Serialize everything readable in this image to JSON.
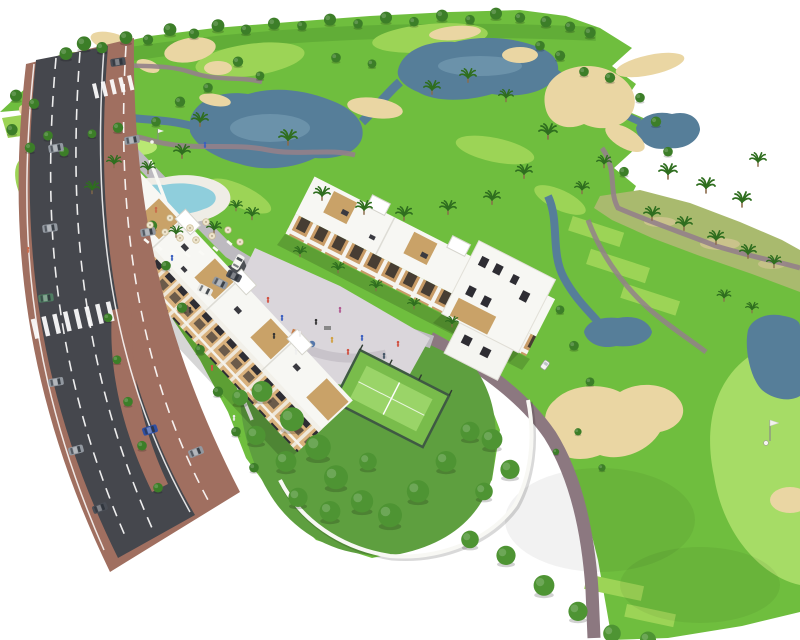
{
  "scene": {
    "alt_text": "Aerial 3D architectural render of a white apartment resort complex beside a golf course, with lakes, sand bunkers, palm trees, a lagoon swimming pool, a padel court, a central plaza and a diagonal boulevard with cars",
    "features": [
      "golf-course",
      "fairways",
      "practice-tee-rectangles",
      "putting-green",
      "lakes",
      "stream",
      "ponds",
      "sand-bunkers",
      "cart-paths",
      "scrub-dunes",
      "palm-trees",
      "round-trees",
      "apartment-buildings",
      "rooftop-terraces",
      "penthouse-boxes",
      "swimming-pool",
      "pool-deck",
      "sun-umbrellas",
      "sun-loungers",
      "central-plaza",
      "playground",
      "padel-court",
      "private-gardens",
      "perimeter-wall",
      "boulevard-road",
      "lane-markings",
      "zebra-crossings",
      "median-island",
      "sidewalks",
      "cars",
      "parking-area",
      "internal-street",
      "golf-cart",
      "golfer-with-flag",
      "pedestrians"
    ]
  },
  "colors": {
    "background": "#ffffff",
    "course_green": "#6FBE3E",
    "course_light": "#9CD456",
    "course_dark": "#4F9A2E",
    "putting_green": "#B9E873",
    "fairway_right": "#A6DC66",
    "scrub": "#A9BA6E",
    "water": "#567E99",
    "water_light": "#7FA6BC",
    "sand": "#EAD6A3",
    "path": "#93818A",
    "cart_path": "#8C7880",
    "road": "#45474D",
    "road_line": "#FFFFFF",
    "sidewalk": "#A06F60",
    "building_white": "#F7F7F3",
    "facade_tan": "#D9B17C",
    "window_dark": "#2E2D33",
    "wood": "#C9A268",
    "plaza": "#DAD6DB",
    "pool_water": "#8FCEDC",
    "pool_deck": "#EFEDE6",
    "padel_fence": "#3F5A43",
    "padel_court": "#79BC4B",
    "padel_surface": "#9AD468",
    "tree": "#3C7E28",
    "tree_light": "#4E9433",
    "palm": "#2F6E1F",
    "garden_green": "#5E9F3F",
    "parking": "#4E5156",
    "wall_white": "#F8F8F4",
    "car_grey": "#9298A0",
    "car_green": "#4F7D62",
    "car_blue": "#2E4FA3",
    "car_dark": "#4A4E56",
    "cart_white": "#F5F5F2"
  }
}
